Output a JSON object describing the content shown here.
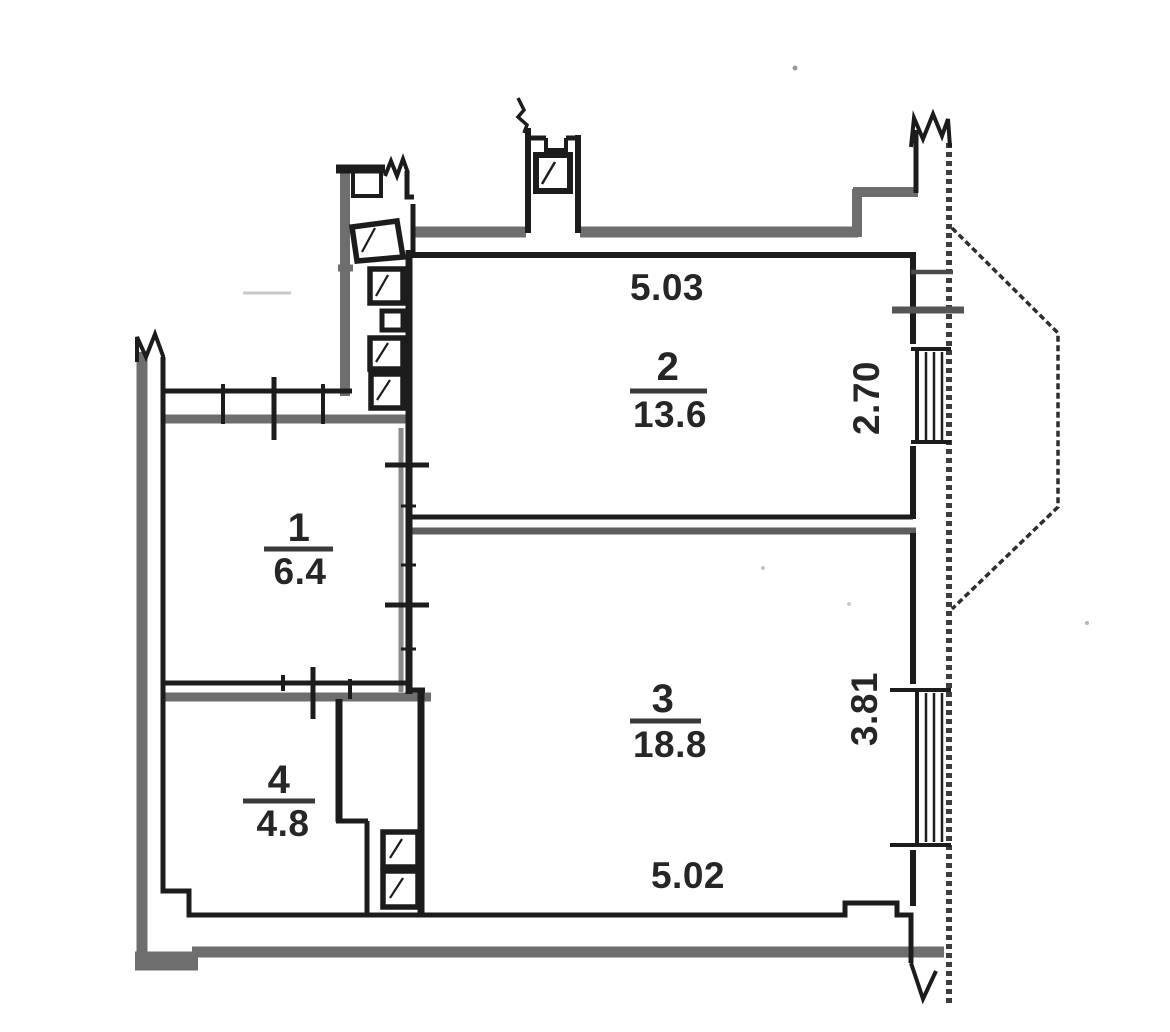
{
  "plan": {
    "rooms": [
      {
        "number": "1",
        "area": "6.4"
      },
      {
        "number": "2",
        "area": "13.6"
      },
      {
        "number": "3",
        "area": "18.8"
      },
      {
        "number": "4",
        "area": "4.8"
      }
    ],
    "dimensions": {
      "room2_width": "5.03",
      "room2_depth": "2.70",
      "room3_depth": "3.81",
      "room3_width": "5.02"
    },
    "colors": {
      "line": "#1c1c1c",
      "wall_gray": "#6e6e6e",
      "text": "#262626",
      "background": "#ffffff"
    }
  }
}
